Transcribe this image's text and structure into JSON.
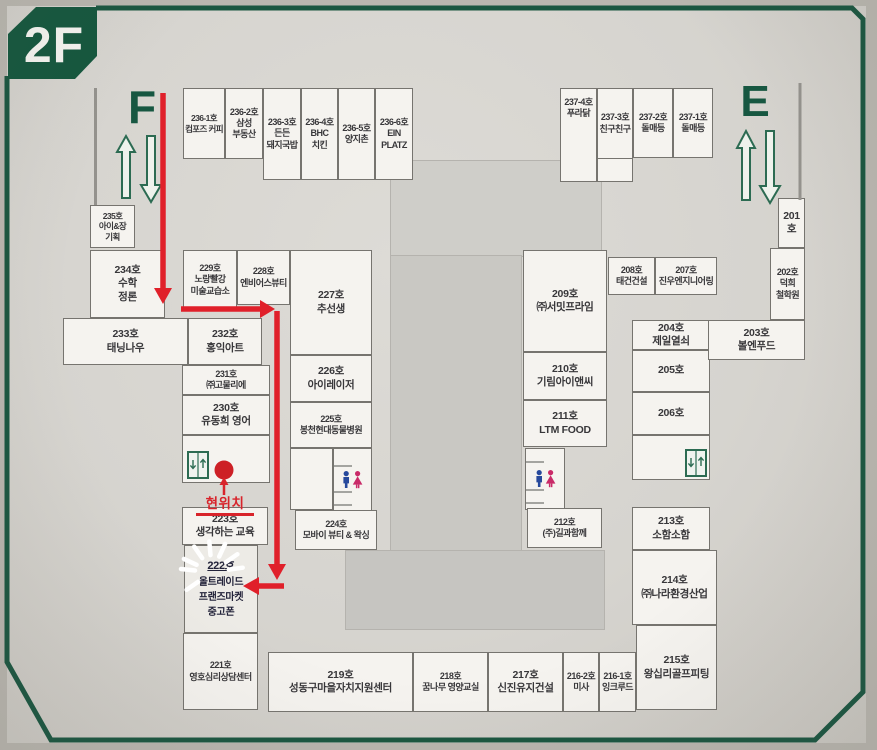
{
  "floor": {
    "label": "2F"
  },
  "escalators": {
    "west_label": "F",
    "east_label": "E"
  },
  "current_location": {
    "label": "현위치"
  },
  "icons": {
    "escalator_up": "escalator-up-arrow-icon",
    "escalator_down": "escalator-down-arrow-icon",
    "elevator": "elevator-icon",
    "restroom_man": "restroom-man-icon",
    "restroom_woman": "restroom-woman-icon",
    "current_location_dot": "current-location-dot",
    "route": "route-arrow",
    "highlight": "starburst-highlight"
  },
  "colors": {
    "banner_green": "#15573e",
    "border_green": "#1a5640",
    "route_red": "#e0202a",
    "dot_red": "#cd2026",
    "man_blue": "#27499c",
    "woman_pink": "#c92a68",
    "room_fill": "#f5f3ef",
    "map_gray": "#d6d4cf"
  },
  "rooms": [
    {
      "id": "236-1호",
      "name": "컴포즈 커피",
      "bbox": [
        183,
        88,
        42,
        71
      ],
      "cls": "xs"
    },
    {
      "id": "236-2호",
      "name": "삼성\n부동산",
      "bbox": [
        225,
        88,
        38,
        71
      ],
      "cls": "sm"
    },
    {
      "id": "236-3호",
      "name": "든든\n돼지국밥",
      "bbox": [
        263,
        88,
        38,
        92
      ],
      "cls": "sm"
    },
    {
      "id": "236-4호",
      "name": "BHC\n치킨",
      "bbox": [
        301,
        88,
        37,
        92
      ],
      "cls": "sm"
    },
    {
      "id": "236-5호",
      "name": "양지촌",
      "bbox": [
        338,
        88,
        37,
        92
      ],
      "cls": "sm"
    },
    {
      "id": "236-6호",
      "name": "EIN\nPLATZ",
      "bbox": [
        375,
        88,
        38,
        92
      ],
      "cls": "sm"
    },
    {
      "id": "237-4호",
      "name": "푸라닭",
      "bbox": [
        560,
        88,
        37,
        94
      ],
      "cls": "vtop sm"
    },
    {
      "id": "237-3호",
      "name": "친구친구",
      "bbox": [
        597,
        88,
        36,
        71
      ],
      "cls": "sm"
    },
    {
      "id": "",
      "name": "",
      "bbox": [
        597,
        158,
        36,
        24
      ]
    },
    {
      "id": "237-2호",
      "name": "돌매등",
      "bbox": [
        633,
        88,
        40,
        70
      ],
      "cls": "sm"
    },
    {
      "id": "237-1호",
      "name": "돌매등",
      "bbox": [
        673,
        88,
        40,
        70
      ],
      "cls": "sm"
    },
    {
      "id": "235호",
      "name": "아이&장\n기획",
      "bbox": [
        90,
        205,
        45,
        43
      ],
      "cls": "xs"
    },
    {
      "id": "234호",
      "name": "수학\n정론",
      "bbox": [
        90,
        250,
        75,
        68
      ]
    },
    {
      "id": "233호",
      "name": "태닝나우",
      "bbox": [
        63,
        318,
        125,
        47
      ]
    },
    {
      "id": "232호",
      "name": "홍익아트",
      "bbox": [
        188,
        318,
        74,
        47
      ]
    },
    {
      "id": "231호",
      "name": "㈜고물리에",
      "bbox": [
        182,
        365,
        88,
        30
      ],
      "cls": "sm"
    },
    {
      "id": "230호",
      "name": "유동희 영어",
      "bbox": [
        182,
        395,
        88,
        40
      ]
    },
    {
      "id": "",
      "name": "",
      "bbox": [
        182,
        435,
        88,
        48
      ]
    },
    {
      "id": "223호",
      "name": "생각하는 교육",
      "bbox": [
        182,
        507,
        86,
        38
      ]
    },
    {
      "id": "222호",
      "name": "올트레이드\n프랜즈마켓\n중고폰",
      "bbox": [
        184,
        545,
        74,
        88
      ],
      "cls": "handwritten"
    },
    {
      "id": "221호",
      "name": "영호심리상담센터",
      "bbox": [
        183,
        633,
        75,
        77
      ],
      "cls": "sm"
    },
    {
      "id": "229호",
      "name": "노랑빨강\n미술교습소",
      "bbox": [
        183,
        250,
        54,
        60
      ],
      "cls": "sm"
    },
    {
      "id": "228호",
      "name": "엔비어스뷰티",
      "bbox": [
        237,
        250,
        53,
        55
      ],
      "cls": "sm"
    },
    {
      "id": "227호",
      "name": "추선생",
      "bbox": [
        290,
        250,
        82,
        105
      ]
    },
    {
      "id": "226호",
      "name": "아이레이저",
      "bbox": [
        290,
        355,
        82,
        47
      ]
    },
    {
      "id": "225호",
      "name": "봉천현대동물병원",
      "bbox": [
        290,
        402,
        82,
        46
      ],
      "cls": "sm"
    },
    {
      "id": "",
      "name": "",
      "bbox": [
        290,
        448,
        43,
        62
      ]
    },
    {
      "id": "",
      "name": "",
      "bbox": [
        333,
        448,
        39,
        67
      ],
      "cls": "wc"
    },
    {
      "id": "224호",
      "name": "모바이 뷰티 & 왁싱",
      "bbox": [
        295,
        510,
        82,
        40
      ],
      "cls": "sm"
    },
    {
      "id": "209호",
      "name": "㈜서밋프라임",
      "bbox": [
        523,
        250,
        84,
        102
      ]
    },
    {
      "id": "210호",
      "name": "기림아이앤씨",
      "bbox": [
        523,
        352,
        84,
        48
      ]
    },
    {
      "id": "211호",
      "name": "LTM FOOD",
      "bbox": [
        523,
        400,
        84,
        47
      ]
    },
    {
      "id": "",
      "name": "",
      "bbox": [
        525,
        448,
        40,
        62
      ],
      "cls": "wc"
    },
    {
      "id": "212호",
      "name": "(주)길과함께",
      "bbox": [
        527,
        508,
        75,
        40
      ],
      "cls": "sm"
    },
    {
      "id": "208호",
      "name": "태건건설",
      "bbox": [
        608,
        257,
        47,
        38
      ],
      "cls": "sm"
    },
    {
      "id": "207호",
      "name": "진우엔지니어링",
      "bbox": [
        655,
        257,
        62,
        38
      ],
      "cls": "sm"
    },
    {
      "id": "204호",
      "name": "제일열쇠",
      "bbox": [
        632,
        320,
        78,
        30
      ]
    },
    {
      "id": "205호",
      "name": "",
      "bbox": [
        632,
        350,
        78,
        42
      ]
    },
    {
      "id": "206호",
      "name": "",
      "bbox": [
        632,
        392,
        78,
        43
      ]
    },
    {
      "id": "",
      "name": "",
      "bbox": [
        632,
        435,
        78,
        45
      ]
    },
    {
      "id": "213호",
      "name": "소함소함",
      "bbox": [
        632,
        507,
        78,
        43
      ]
    },
    {
      "id": "214호",
      "name": "㈜나라환경산업",
      "bbox": [
        632,
        550,
        85,
        75
      ]
    },
    {
      "id": "215호",
      "name": "왕십리골프피팅",
      "bbox": [
        636,
        625,
        81,
        85
      ]
    },
    {
      "id": "201호",
      "name": "",
      "bbox": [
        778,
        198,
        27,
        50
      ]
    },
    {
      "id": "202호",
      "name": "덕희\n철학원",
      "bbox": [
        770,
        248,
        35,
        72
      ],
      "cls": "sm"
    },
    {
      "id": "203호",
      "name": "볼엔푸드",
      "bbox": [
        708,
        320,
        97,
        40
      ]
    },
    {
      "id": "219호",
      "name": "성동구마을자치지원센터",
      "bbox": [
        268,
        652,
        145,
        60
      ]
    },
    {
      "id": "218호",
      "name": "꿈나무 영양교실",
      "bbox": [
        413,
        652,
        75,
        60
      ],
      "cls": "sm"
    },
    {
      "id": "217호",
      "name": "신진유지건설",
      "bbox": [
        488,
        652,
        75,
        60
      ]
    },
    {
      "id": "216-2호",
      "name": "미사",
      "bbox": [
        563,
        652,
        36,
        60
      ],
      "cls": "sm"
    },
    {
      "id": "216-1호",
      "name": "잉크루드",
      "bbox": [
        599,
        652,
        37,
        60
      ],
      "cls": "sm"
    }
  ]
}
